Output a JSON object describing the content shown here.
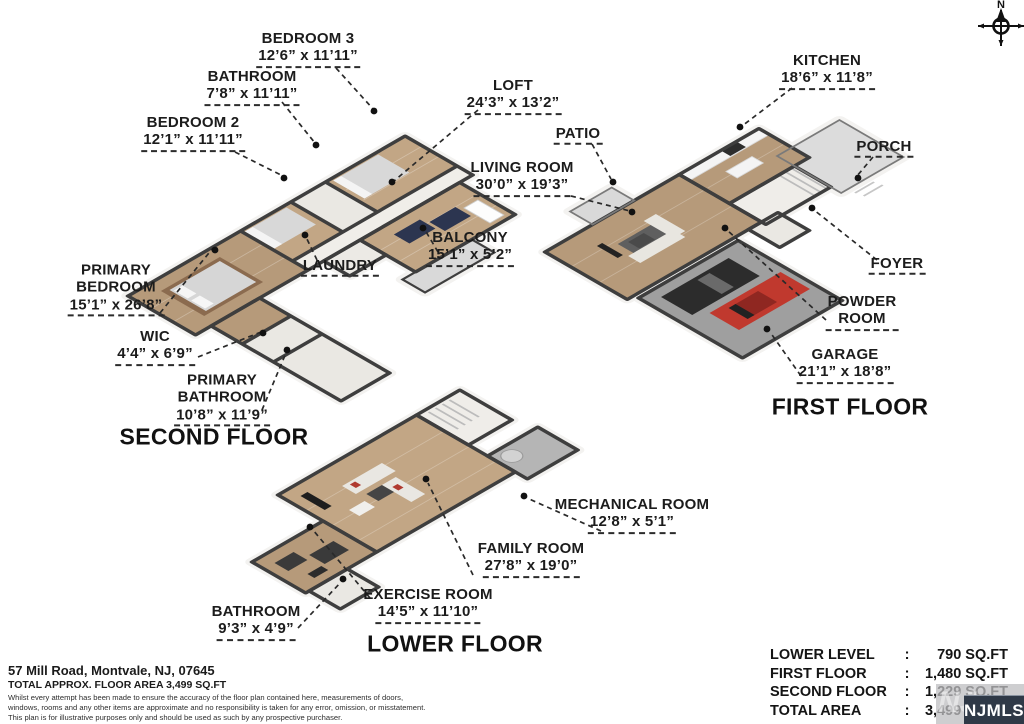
{
  "compass": {
    "north_label": "N"
  },
  "floors": [
    {
      "id": "second",
      "title": "SECOND FLOOR",
      "rooms": [
        {
          "id": "bedroom3",
          "name": "BEDROOM 3",
          "dims": "12’6” x 11’11”"
        },
        {
          "id": "bathroom2",
          "name": "BATHROOM",
          "dims": "7’8” x 11’11”"
        },
        {
          "id": "bedroom2",
          "name": "BEDROOM 2",
          "dims": "12’1” x 11’11”"
        },
        {
          "id": "loft",
          "name": "LOFT",
          "dims": "24’3” x 13’2”"
        },
        {
          "id": "laundry",
          "name": "LAUNDRY",
          "dims": ""
        },
        {
          "id": "balcony",
          "name": "BALCONY",
          "dims": "15’1” x 5’2”"
        },
        {
          "id": "primary-bedroom",
          "name": "PRIMARY\nBEDROOM",
          "dims": "15’1” x 26’8”"
        },
        {
          "id": "wic",
          "name": "WIC",
          "dims": "4’4” x 6’9”"
        },
        {
          "id": "primary-bathroom",
          "name": "PRIMARY\nBATHROOM",
          "dims": "10’8” x 11’9”"
        }
      ]
    },
    {
      "id": "first",
      "title": "FIRST FLOOR",
      "rooms": [
        {
          "id": "kitchen",
          "name": "KITCHEN",
          "dims": "18’6” x 11’8”"
        },
        {
          "id": "patio",
          "name": "PATIO",
          "dims": ""
        },
        {
          "id": "porch",
          "name": "PORCH",
          "dims": ""
        },
        {
          "id": "living-room",
          "name": "LIVING ROOM",
          "dims": "30’0” x 19’3”"
        },
        {
          "id": "foyer",
          "name": "FOYER",
          "dims": ""
        },
        {
          "id": "powder-room",
          "name": "POWDER\nROOM",
          "dims": ""
        },
        {
          "id": "garage",
          "name": "GARAGE",
          "dims": "21’1” x 18’8”"
        }
      ]
    },
    {
      "id": "lower",
      "title": "LOWER FLOOR",
      "rooms": [
        {
          "id": "mechanical-room",
          "name": "MECHANICAL ROOM",
          "dims": "12’8” x 5’1”"
        },
        {
          "id": "family-room",
          "name": "FAMILY ROOM",
          "dims": "27’8” x 19’0”"
        },
        {
          "id": "exercise-room",
          "name": "EXERCISE ROOM",
          "dims": "14’5” x 11’10”"
        },
        {
          "id": "bathroom-lower",
          "name": "BATHROOM",
          "dims": "9’3” x 4’9”"
        }
      ]
    }
  ],
  "area_table": {
    "rows": [
      {
        "label": "LOWER LEVEL",
        "value": "790 SQ.FT"
      },
      {
        "label": "FIRST FLOOR",
        "value": "1,480 SQ.FT"
      },
      {
        "label": "SECOND FLOOR",
        "value": "1,229 SQ.FT"
      },
      {
        "label": "TOTAL AREA",
        "value": "3,499 SQ.FT"
      }
    ],
    "separator": ":"
  },
  "footer": {
    "address": "57 Mill Road, Montvale, NJ, 07645",
    "area_line": "TOTAL APPROX. FLOOR AREA 3,499 SQ.FT",
    "disclaimer_lines": [
      "Whilst every attempt has been made to ensure the accuracy of the floor plan contained here, measurements of doors,",
      "windows, rooms and any other items are approximate and no responsibility is taken for any error, omission, or misstatement.",
      "This plan is for illustrative purposes only and should be used as such by any prospective purchaser."
    ]
  },
  "watermark": {
    "badge": "NJMLS",
    "ghost": "NJ"
  },
  "colors": {
    "wood": "#b69a7a",
    "wood_light": "#c2a685",
    "tile": "#eae8e3",
    "hall": "#f0eee9",
    "deck": "#d9d9d9",
    "garage_floor": "#9f9f9f",
    "wall": "#3e3e3e",
    "car_red": "#c0392e",
    "car_black": "#2c2c2c",
    "badge_bg": "#2f3947"
  }
}
